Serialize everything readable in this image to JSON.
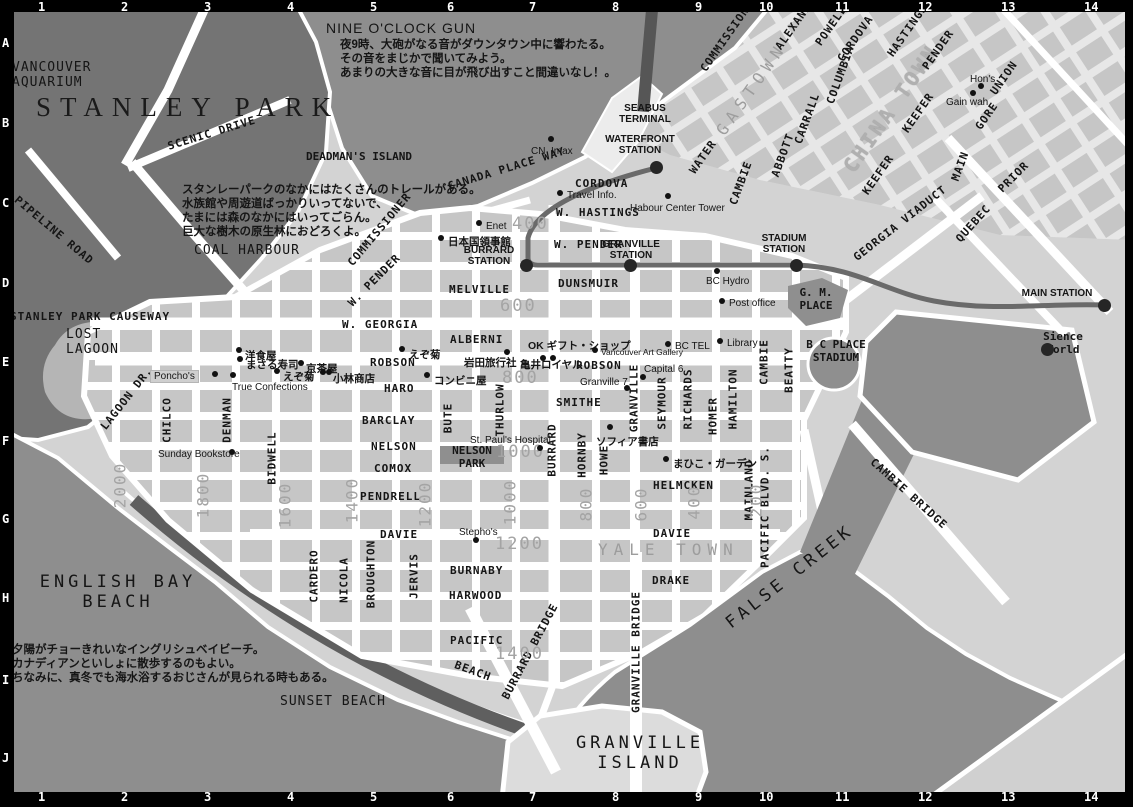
{
  "colors": {
    "water": "#8e8e8e",
    "park": "#747474",
    "land": "#d3d3d3",
    "land_ne": "#dedede",
    "block": "#c6c6c6",
    "block_ne": "#c2c2c2",
    "street": "#ffffff",
    "beach": "#5f5f5f",
    "lagoon": "#b5b5b5",
    "rail": "#6a6a6a",
    "station_dot": "#262626",
    "dark_blob": "#8f8f8f",
    "island": "#dcdcdc",
    "gray_label": "#9d9d9d",
    "frame": "#000000"
  },
  "grid": {
    "cols": [
      {
        "t": "1",
        "x": 42
      },
      {
        "t": "2",
        "x": 125
      },
      {
        "t": "3",
        "x": 208
      },
      {
        "t": "4",
        "x": 291
      },
      {
        "t": "5",
        "x": 374
      },
      {
        "t": "6",
        "x": 451
      },
      {
        "t": "7",
        "x": 533
      },
      {
        "t": "8",
        "x": 616
      },
      {
        "t": "9",
        "x": 699
      },
      {
        "t": "10",
        "x": 763
      },
      {
        "t": "11",
        "x": 839
      },
      {
        "t": "12",
        "x": 922
      },
      {
        "t": "13",
        "x": 1005
      },
      {
        "t": "14",
        "x": 1088
      }
    ],
    "rows": [
      {
        "t": "A",
        "y": 43
      },
      {
        "t": "B",
        "y": 123
      },
      {
        "t": "C",
        "y": 203
      },
      {
        "t": "D",
        "y": 283
      },
      {
        "t": "E",
        "y": 362
      },
      {
        "t": "F",
        "y": 441
      },
      {
        "t": "G",
        "y": 519
      },
      {
        "t": "H",
        "y": 598
      },
      {
        "t": "I",
        "y": 680
      },
      {
        "t": "J",
        "y": 758
      }
    ]
  },
  "areas": [
    {
      "t": "VANCOUVER\nAQUARIUM",
      "x": 12,
      "y": 60,
      "c": "area-md"
    },
    {
      "t": "STANLEY PARK",
      "x": 36,
      "y": 92,
      "c": "area-xl"
    },
    {
      "t": "DEADMAN'S ISLAND",
      "x": 306,
      "y": 150,
      "c": "area-sm"
    },
    {
      "t": "COAL HARBOUR",
      "x": 194,
      "y": 243,
      "c": "area-md"
    },
    {
      "t": "LOST\nLAGOON",
      "x": 66,
      "y": 327,
      "c": "area-md"
    },
    {
      "t": "ENGLISH BAY\nBEACH",
      "x": 118,
      "y": 572,
      "c": "area-lg ctr"
    },
    {
      "t": "SUNSET BEACH",
      "x": 280,
      "y": 694,
      "c": "area-md"
    },
    {
      "t": "GRANVILLE\nISLAND",
      "x": 640,
      "y": 733,
      "c": "area-lg ctr"
    },
    {
      "t": "FALSE CREEK",
      "x": 728,
      "y": 615,
      "c": "area-lg",
      "r": -38
    },
    {
      "t": "YALE TOWN",
      "x": 598,
      "y": 540,
      "c": "area-gray"
    },
    {
      "t": "GASTOWN",
      "x": 720,
      "y": 124,
      "c": "area-gray",
      "r": -55
    },
    {
      "t": "CHINA TOWN",
      "x": 848,
      "y": 158,
      "c": "area-gray-lg",
      "r": -55
    },
    {
      "t": "G. M.\nPLACE",
      "x": 816,
      "y": 286,
      "c": "area-sm ctr"
    },
    {
      "t": "B C PLACE\nSTADIUM",
      "x": 836,
      "y": 338,
      "c": "area-sm ctr"
    },
    {
      "t": "Sience\nWorld",
      "x": 1063,
      "y": 330,
      "c": "area-sm ctr"
    },
    {
      "t": "NELSON\nPARK",
      "x": 472,
      "y": 444,
      "c": "area-sm ctr"
    },
    {
      "t": "NINE O'CLOCK GUN",
      "x": 326,
      "y": 20,
      "c": "note-title"
    }
  ],
  "streets": [
    {
      "t": "CORDOVA",
      "x": 575,
      "y": 177,
      "c": "st"
    },
    {
      "t": "W. HASTINGS",
      "x": 556,
      "y": 206,
      "c": "st"
    },
    {
      "t": "W. PENDER",
      "x": 554,
      "y": 238,
      "c": "st"
    },
    {
      "t": "DUNSMUIR",
      "x": 558,
      "y": 277,
      "c": "st"
    },
    {
      "t": "MELVILLE",
      "x": 449,
      "y": 283,
      "c": "st"
    },
    {
      "t": "W. GEORGIA",
      "x": 342,
      "y": 318,
      "c": "st"
    },
    {
      "t": "ALBERNI",
      "x": 450,
      "y": 333,
      "c": "st"
    },
    {
      "t": "ROBSON",
      "x": 370,
      "y": 356,
      "c": "st"
    },
    {
      "t": "ROBSON",
      "x": 576,
      "y": 359,
      "c": "st"
    },
    {
      "t": "HARO",
      "x": 384,
      "y": 382,
      "c": "st"
    },
    {
      "t": "BARCLAY",
      "x": 362,
      "y": 414,
      "c": "st"
    },
    {
      "t": "NELSON",
      "x": 371,
      "y": 440,
      "c": "st"
    },
    {
      "t": "COMOX",
      "x": 374,
      "y": 462,
      "c": "st"
    },
    {
      "t": "PENDRELL",
      "x": 360,
      "y": 490,
      "c": "st"
    },
    {
      "t": "DAVIE",
      "x": 380,
      "y": 528,
      "c": "st"
    },
    {
      "t": "DAVIE",
      "x": 653,
      "y": 527,
      "c": "st"
    },
    {
      "t": "BURNABY",
      "x": 450,
      "y": 564,
      "c": "st"
    },
    {
      "t": "HARWOOD",
      "x": 449,
      "y": 589,
      "c": "st"
    },
    {
      "t": "PACIFIC",
      "x": 450,
      "y": 634,
      "c": "st"
    },
    {
      "t": "SMITHE",
      "x": 556,
      "y": 396,
      "c": "st"
    },
    {
      "t": "HELMCKEN",
      "x": 653,
      "y": 479,
      "c": "st"
    },
    {
      "t": "DRAKE",
      "x": 652,
      "y": 574,
      "c": "st"
    },
    {
      "t": "CHILCO",
      "x": 167,
      "y": 420,
      "c": "st-v"
    },
    {
      "t": "DENMAN",
      "x": 227,
      "y": 420,
      "c": "st-v"
    },
    {
      "t": "BIDWELL",
      "x": 272,
      "y": 458,
      "c": "st-v"
    },
    {
      "t": "CARDERO",
      "x": 314,
      "y": 576,
      "c": "st-v"
    },
    {
      "t": "NICOLA",
      "x": 344,
      "y": 580,
      "c": "st-v"
    },
    {
      "t": "BROUGHTON",
      "x": 371,
      "y": 574,
      "c": "st-v"
    },
    {
      "t": "JERVIS",
      "x": 414,
      "y": 576,
      "c": "st-v"
    },
    {
      "t": "BUTE",
      "x": 448,
      "y": 418,
      "c": "st-v"
    },
    {
      "t": "THURLOW",
      "x": 500,
      "y": 410,
      "c": "st-v"
    },
    {
      "t": "BURRARD",
      "x": 552,
      "y": 450,
      "c": "st-v"
    },
    {
      "t": "HORNBY",
      "x": 582,
      "y": 455,
      "c": "st-v"
    },
    {
      "t": "HOWE",
      "x": 604,
      "y": 460,
      "c": "st-v"
    },
    {
      "t": "GRANVILLE",
      "x": 634,
      "y": 398,
      "c": "st-v"
    },
    {
      "t": "SEYMOUR",
      "x": 662,
      "y": 403,
      "c": "st-v"
    },
    {
      "t": "RICHARDS",
      "x": 688,
      "y": 399,
      "c": "st-v"
    },
    {
      "t": "HOMER",
      "x": 713,
      "y": 416,
      "c": "st-v"
    },
    {
      "t": "HAMILTON",
      "x": 733,
      "y": 399,
      "c": "st-v"
    },
    {
      "t": "CAMBIE",
      "x": 764,
      "y": 362,
      "c": "st-v"
    },
    {
      "t": "BEATTY",
      "x": 789,
      "y": 370,
      "c": "st-v"
    },
    {
      "t": "MAINLAND",
      "x": 749,
      "y": 490,
      "c": "st-v"
    },
    {
      "t": "GRANVILLE BRIDGE",
      "x": 636,
      "y": 652,
      "c": "st-v"
    },
    {
      "t": "SCENIC DRIVE",
      "x": 168,
      "y": 140,
      "c": "st",
      "r": -17
    },
    {
      "t": "PIPELINE ROAD",
      "x": 16,
      "y": 192,
      "c": "st",
      "r": 40
    },
    {
      "t": "STANLEY PARK CAUSEWAY",
      "x": 10,
      "y": 310,
      "c": "st"
    },
    {
      "t": "LAGOON DR.",
      "x": 103,
      "y": 422,
      "c": "st",
      "r": -52
    },
    {
      "t": "CANADA PLACE WAY",
      "x": 448,
      "y": 180,
      "c": "st",
      "r": -17
    },
    {
      "t": "COMMISSIONER",
      "x": 350,
      "y": 258,
      "c": "st",
      "r": -50
    },
    {
      "t": "W. PENDER",
      "x": 350,
      "y": 298,
      "c": "st",
      "r": -45
    },
    {
      "t": "COMMISSIONER",
      "x": 703,
      "y": 64,
      "c": "st",
      "r": -55
    },
    {
      "t": "ALEXANDER",
      "x": 778,
      "y": 42,
      "c": "st",
      "r": -55
    },
    {
      "t": "POWELL",
      "x": 818,
      "y": 38,
      "c": "st",
      "r": -55
    },
    {
      "t": "CORDOVA",
      "x": 840,
      "y": 54,
      "c": "st",
      "r": -55
    },
    {
      "t": "HASTINGS",
      "x": 890,
      "y": 49,
      "c": "st",
      "r": -55
    },
    {
      "t": "PENDER",
      "x": 925,
      "y": 62,
      "c": "st",
      "r": -55
    },
    {
      "t": "COLUMBIA",
      "x": 830,
      "y": 97,
      "c": "st",
      "r": -70
    },
    {
      "t": "WATER",
      "x": 692,
      "y": 166,
      "c": "st",
      "r": -55
    },
    {
      "t": "CARRALL",
      "x": 798,
      "y": 137,
      "c": "st",
      "r": -70
    },
    {
      "t": "ABBOTT",
      "x": 775,
      "y": 170,
      "c": "st",
      "r": -70
    },
    {
      "t": "CAMBIE",
      "x": 733,
      "y": 198,
      "c": "st",
      "r": -70
    },
    {
      "t": "KEEFER",
      "x": 905,
      "y": 125,
      "c": "st",
      "r": -55
    },
    {
      "t": "KEEFER",
      "x": 865,
      "y": 187,
      "c": "st",
      "r": -55
    },
    {
      "t": "MAIN",
      "x": 955,
      "y": 174,
      "c": "st",
      "r": -70
    },
    {
      "t": "GORE",
      "x": 978,
      "y": 122,
      "c": "st",
      "r": -55
    },
    {
      "t": "UNION",
      "x": 993,
      "y": 87,
      "c": "st",
      "r": -55
    },
    {
      "t": "PRIOR",
      "x": 1000,
      "y": 184,
      "c": "st",
      "r": -45
    },
    {
      "t": "GEORGIA VIADUCT",
      "x": 855,
      "y": 252,
      "c": "st",
      "r": -38
    },
    {
      "t": "QUEBEC",
      "x": 958,
      "y": 234,
      "c": "st",
      "r": -48
    },
    {
      "t": "PACIFIC BLVD. S.",
      "x": 765,
      "y": 507,
      "c": "st-v"
    },
    {
      "t": "BEACH",
      "x": 455,
      "y": 658,
      "c": "st",
      "r": 20
    },
    {
      "t": "BURRARD BRIDGE",
      "x": 505,
      "y": 692,
      "c": "st",
      "r": -62
    },
    {
      "t": "CAMBIE BRIDGE",
      "x": 872,
      "y": 454,
      "c": "st",
      "r": 42
    }
  ],
  "numbers": [
    {
      "t": "400",
      "x": 512,
      "y": 214,
      "c": "num"
    },
    {
      "t": "600",
      "x": 500,
      "y": 296,
      "c": "num"
    },
    {
      "t": "800",
      "x": 502,
      "y": 368,
      "c": "num"
    },
    {
      "t": "1000",
      "x": 496,
      "y": 442,
      "c": "num"
    },
    {
      "t": "1200",
      "x": 495,
      "y": 534,
      "c": "num"
    },
    {
      "t": "1400",
      "x": 495,
      "y": 644,
      "c": "num"
    },
    {
      "t": "2000",
      "x": 120,
      "y": 485,
      "c": "num-v"
    },
    {
      "t": "1800",
      "x": 203,
      "y": 495,
      "c": "num-v"
    },
    {
      "t": "1600",
      "x": 285,
      "y": 505,
      "c": "num-v"
    },
    {
      "t": "1400",
      "x": 352,
      "y": 500,
      "c": "num-v"
    },
    {
      "t": "1200",
      "x": 425,
      "y": 504,
      "c": "num-v"
    },
    {
      "t": "1000",
      "x": 510,
      "y": 502,
      "c": "num-v"
    },
    {
      "t": "800",
      "x": 586,
      "y": 504,
      "c": "num-v"
    },
    {
      "t": "600",
      "x": 641,
      "y": 504,
      "c": "num-v"
    },
    {
      "t": "400",
      "x": 694,
      "y": 502,
      "c": "num-v"
    },
    {
      "t": "200",
      "x": 756,
      "y": 500,
      "c": "num-v"
    }
  ],
  "pois": [
    {
      "t": "CN  Imax",
      "x": 531,
      "y": 146,
      "c": "poi"
    },
    {
      "t": "Travel Info.",
      "x": 567,
      "y": 190,
      "c": "poi"
    },
    {
      "t": "Habour Center Tower",
      "x": 630,
      "y": 203,
      "c": "poi"
    },
    {
      "t": "Enet",
      "x": 486,
      "y": 221,
      "c": "poi"
    },
    {
      "t": "日本国領事館",
      "x": 448,
      "y": 234,
      "c": "jp-poi"
    },
    {
      "t": "BC Hydro",
      "x": 706,
      "y": 276,
      "c": "poi"
    },
    {
      "t": "Post office",
      "x": 729,
      "y": 298,
      "c": "poi"
    },
    {
      "t": "Library",
      "x": 727,
      "y": 338,
      "c": "poi"
    },
    {
      "t": "BC TEL",
      "x": 675,
      "y": 341,
      "c": "poi"
    },
    {
      "t": "Vancouver Art Gallery",
      "x": 601,
      "y": 347,
      "c": "poi-sm"
    },
    {
      "t": "Capital 6",
      "x": 644,
      "y": 364,
      "c": "poi"
    },
    {
      "t": "Granville 7",
      "x": 580,
      "y": 377,
      "c": "poi"
    },
    {
      "t": "OK ギフト・ショップ",
      "x": 528,
      "y": 338,
      "c": "jp-poi"
    },
    {
      "t": "岩田旅行社",
      "x": 464,
      "y": 355,
      "c": "jp-poi"
    },
    {
      "t": "亀井ロイヤル",
      "x": 520,
      "y": 357,
      "c": "jp-poi"
    },
    {
      "t": "コンビニ屋",
      "x": 434,
      "y": 373,
      "c": "jp-poi"
    },
    {
      "t": "えぞ菊",
      "x": 409,
      "y": 347,
      "c": "jp-poi"
    },
    {
      "t": "えぞ菊",
      "x": 283,
      "y": 369,
      "c": "jp-poi"
    },
    {
      "t": "洋食屋",
      "x": 245,
      "y": 348,
      "c": "jp-poi"
    },
    {
      "t": "まさる寿司",
      "x": 246,
      "y": 357,
      "c": "jp-poi"
    },
    {
      "t": "京茶屋",
      "x": 306,
      "y": 361,
      "c": "jp-poi"
    },
    {
      "t": "小林商店",
      "x": 333,
      "y": 371,
      "c": "jp-poi"
    },
    {
      "t": "Poncho's",
      "x": 150,
      "y": 370,
      "c": "poi poi-box"
    },
    {
      "t": "True Confections",
      "x": 232,
      "y": 382,
      "c": "poi"
    },
    {
      "t": "Sunday Bookstore",
      "x": 158,
      "y": 449,
      "c": "poi"
    },
    {
      "t": "St. Paul's Hospital",
      "x": 470,
      "y": 435,
      "c": "poi"
    },
    {
      "t": "Stepho's",
      "x": 459,
      "y": 527,
      "c": "poi"
    },
    {
      "t": "ソフィア書店",
      "x": 596,
      "y": 434,
      "c": "jp-poi"
    },
    {
      "t": "まひこ・ガーデン",
      "x": 673,
      "y": 456,
      "c": "jp-poi"
    },
    {
      "t": "Hon's",
      "x": 970,
      "y": 74,
      "c": "poi"
    },
    {
      "t": "Gain wah",
      "x": 946,
      "y": 97,
      "c": "poi"
    }
  ],
  "dots": [
    {
      "x": 551,
      "y": 139
    },
    {
      "x": 560,
      "y": 193
    },
    {
      "x": 668,
      "y": 196
    },
    {
      "x": 479,
      "y": 223
    },
    {
      "x": 441,
      "y": 238
    },
    {
      "x": 717,
      "y": 271
    },
    {
      "x": 722,
      "y": 301
    },
    {
      "x": 720,
      "y": 341
    },
    {
      "x": 668,
      "y": 344
    },
    {
      "x": 595,
      "y": 350
    },
    {
      "x": 643,
      "y": 377
    },
    {
      "x": 627,
      "y": 388
    },
    {
      "x": 543,
      "y": 358
    },
    {
      "x": 553,
      "y": 358
    },
    {
      "x": 507,
      "y": 352
    },
    {
      "x": 427,
      "y": 375
    },
    {
      "x": 402,
      "y": 349
    },
    {
      "x": 277,
      "y": 371
    },
    {
      "x": 239,
      "y": 350
    },
    {
      "x": 240,
      "y": 359
    },
    {
      "x": 301,
      "y": 363
    },
    {
      "x": 323,
      "y": 372
    },
    {
      "x": 329,
      "y": 372
    },
    {
      "x": 215,
      "y": 374
    },
    {
      "x": 233,
      "y": 375
    },
    {
      "x": 232,
      "y": 452
    },
    {
      "x": 540,
      "y": 448
    },
    {
      "x": 476,
      "y": 540
    },
    {
      "x": 610,
      "y": 427
    },
    {
      "x": 666,
      "y": 459
    },
    {
      "x": 981,
      "y": 86
    },
    {
      "x": 973,
      "y": 93
    }
  ],
  "stations": [
    {
      "t": "SEABUS\nTERMINAL",
      "x": 645,
      "y": 103,
      "c": "sta"
    },
    {
      "t": "WATERFRONT\nSTATION",
      "x": 640,
      "y": 134,
      "c": "sta"
    },
    {
      "t": "BURRARD\nSTATION",
      "x": 489,
      "y": 245,
      "c": "sta"
    },
    {
      "t": "GRANVILLE\nSTATION",
      "x": 631,
      "y": 239,
      "c": "sta"
    },
    {
      "t": "STADIUM\nSTATION",
      "x": 784,
      "y": 233,
      "c": "sta"
    },
    {
      "t": "MAIN STATION",
      "x": 1057,
      "y": 288,
      "c": "sta"
    }
  ],
  "station_dots": [
    {
      "x": 656,
      "y": 167
    },
    {
      "x": 526,
      "y": 265
    },
    {
      "x": 630,
      "y": 265
    },
    {
      "x": 796,
      "y": 265
    },
    {
      "x": 1104,
      "y": 305
    },
    {
      "x": 1047,
      "y": 349
    }
  ],
  "notes": [
    {
      "t": "夜9時、大砲がなる音がダウンタウン中に響わたる。",
      "x": 340,
      "y": 36,
      "c": "jp"
    },
    {
      "t": "その音をまじかで聞いてみよう。",
      "x": 340,
      "y": 50,
      "c": "jp"
    },
    {
      "t": "あまりの大きな音に目が飛び出すこと間違いなし！。",
      "x": 340,
      "y": 64,
      "c": "jp"
    },
    {
      "t": "スタンレーパークのなかにはたくさんのトレールがある。",
      "x": 182,
      "y": 181,
      "c": "jp"
    },
    {
      "t": "水族館や周遊道ばっかりいってないで、",
      "x": 182,
      "y": 195,
      "c": "jp"
    },
    {
      "t": "たまには森のなかにはいってごらん。",
      "x": 182,
      "y": 209,
      "c": "jp"
    },
    {
      "t": "巨大な樹木の原生林におどろくよ。",
      "x": 182,
      "y": 223,
      "c": "jp"
    },
    {
      "t": "夕陽がチョーきれいなイングリシュベイビーチ。",
      "x": 12,
      "y": 641,
      "c": "jp"
    },
    {
      "t": "カナディアンといしょに散歩するのもよい。",
      "x": 12,
      "y": 655,
      "c": "jp"
    },
    {
      "t": "ちなみに、真冬でも海水浴するおじさんが見られる時もある。",
      "x": 12,
      "y": 669,
      "c": "jp"
    }
  ]
}
